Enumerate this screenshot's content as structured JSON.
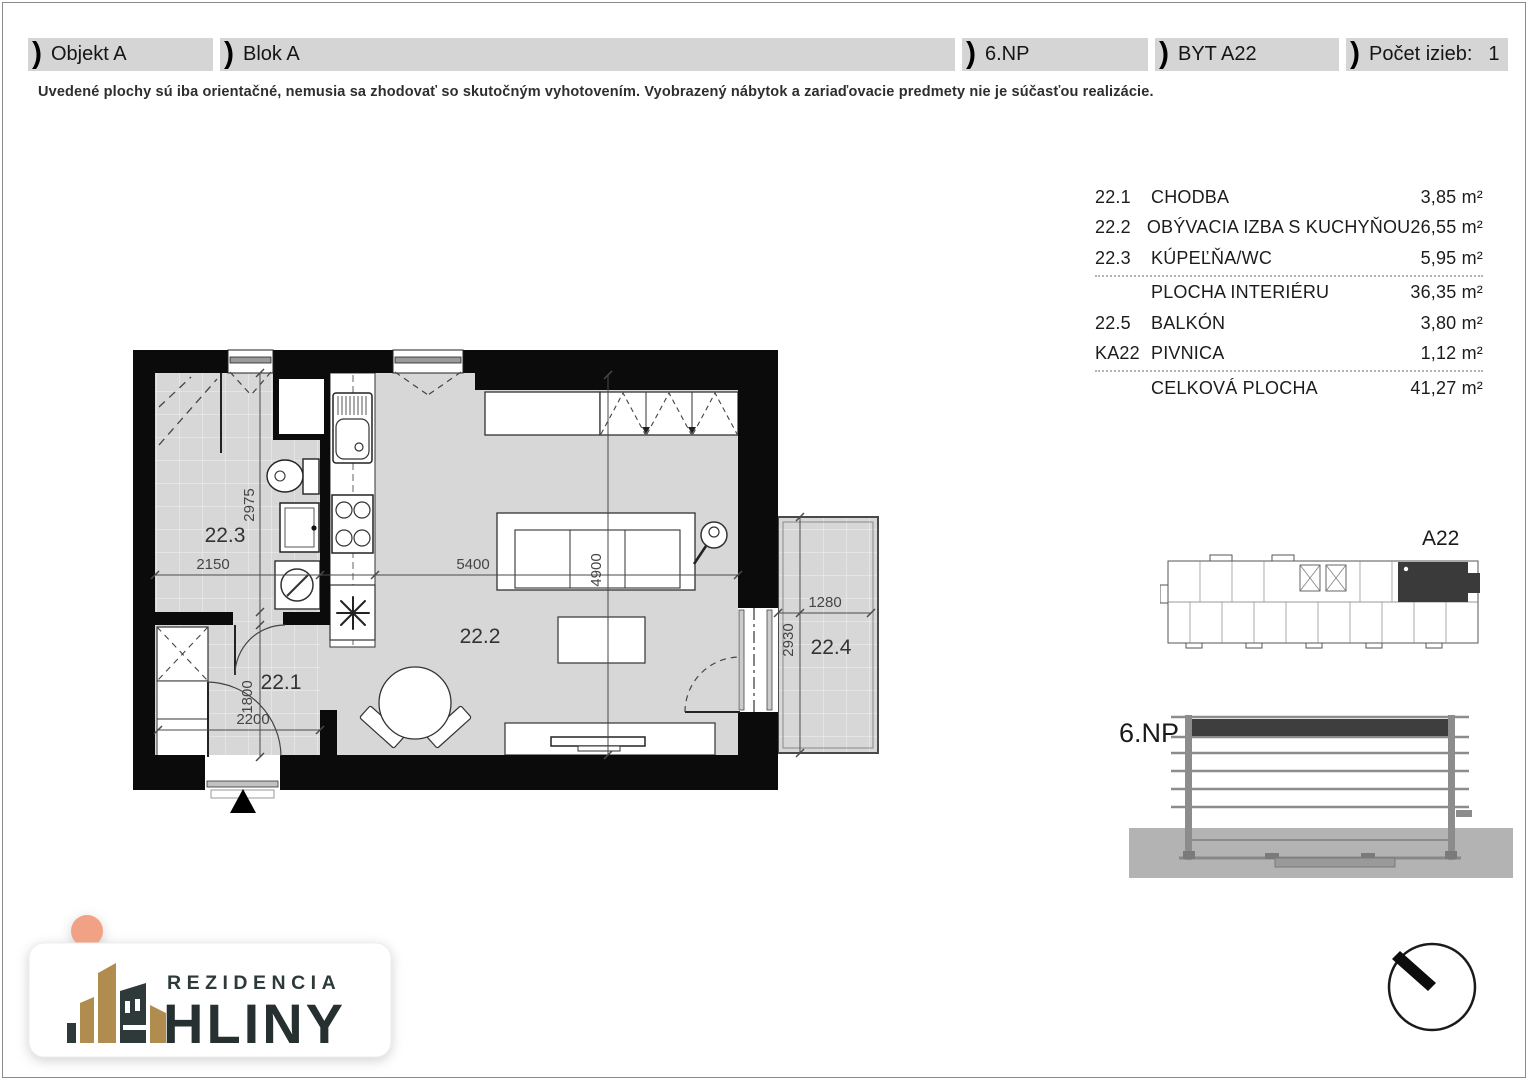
{
  "colors": {
    "header_band": "#d5d5d5",
    "floor_gray": "#d7d7d7",
    "wall_black": "#0b0b0b",
    "highlight_dark": "#3a3a3a",
    "logo_gold": "#B08D4F",
    "logo_ink": "#2E3A3A",
    "logo_peach": "#F2A284"
  },
  "header": {
    "sections": [
      {
        "label": "Objekt A"
      },
      {
        "label": "Blok A"
      },
      {
        "label": "6.NP"
      },
      {
        "label": "BYT A22"
      },
      {
        "label": "Počet izieb:",
        "value": "1"
      }
    ]
  },
  "disclaimer": "Uvedené plochy sú iba orientačné, nemusia sa zhodovať so skutočným vyhotovením. Vyobrazený nábytok a zariaďovacie predmety nie je súčasťou realizácie.",
  "area_table": {
    "rows": [
      {
        "code": "22.1",
        "name": "CHODBA",
        "value": "3,85 m²"
      },
      {
        "code": "22.2",
        "name": "OBÝVACIA IZBA S KUCHYŇOU",
        "value": "26,55 m²"
      },
      {
        "code": "22.3",
        "name": "KÚPEĽŇA/WC",
        "value": "5,95 m²"
      },
      {
        "code": "",
        "name": "PLOCHA INTERIÉRU",
        "value": "36,35 m²"
      },
      {
        "code": "22.5",
        "name": "BALKÓN",
        "value": "3,80 m²"
      },
      {
        "code": "KA22",
        "name": "PIVNICA",
        "value": "1,12 m²"
      },
      {
        "code": "",
        "name": "CELKOVÁ PLOCHA",
        "value": "41,27 m²"
      }
    ]
  },
  "floor_plan": {
    "rooms": {
      "r221": "22.1",
      "r222": "22.2",
      "r223": "22.3",
      "r224": "22.4"
    },
    "dims": {
      "d2975": "2975",
      "d2150": "2150",
      "d5400": "5400",
      "d4900": "4900",
      "d1800": "1800",
      "d2200": "2200",
      "d1280": "1280",
      "d2930": "2930"
    }
  },
  "keyplan": {
    "label": "A22"
  },
  "elevation": {
    "label": "6.NP"
  },
  "logo": {
    "brand_top": "REZIDENCIA",
    "brand_bottom": "HLINY"
  }
}
